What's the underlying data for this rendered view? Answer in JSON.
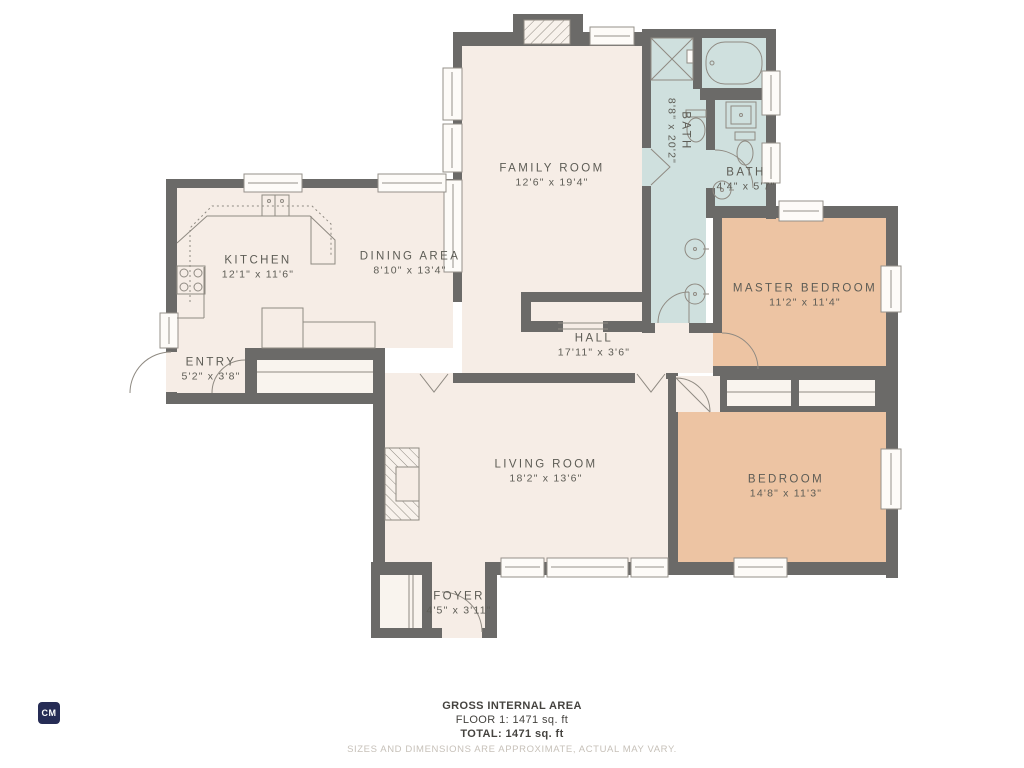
{
  "rooms": [
    {
      "id": "family_room",
      "name": "FAMILY ROOM",
      "dims": "12'6\" x 19'4\""
    },
    {
      "id": "bath_large",
      "name": "BATH",
      "dims": "8'8\" x 20'2\""
    },
    {
      "id": "bath_small",
      "name": "BATH",
      "dims": "4'4\" x 5'7\""
    },
    {
      "id": "kitchen",
      "name": "KITCHEN",
      "dims": "12'1\" x 11'6\""
    },
    {
      "id": "dining_area",
      "name": "DINING AREA",
      "dims": "8'10\" x 13'4\""
    },
    {
      "id": "master_bedroom",
      "name": "MASTER BEDROOM",
      "dims": "11'2\" x 11'4\""
    },
    {
      "id": "hall",
      "name": "HALL",
      "dims": "17'11\" x 3'6\""
    },
    {
      "id": "entry",
      "name": "ENTRY",
      "dims": "5'2\" x 3'8\""
    },
    {
      "id": "living_room",
      "name": "LIVING ROOM",
      "dims": "18'2\" x 13'6\""
    },
    {
      "id": "bedroom",
      "name": "BEDROOM",
      "dims": "14'8\" x 11'3\""
    },
    {
      "id": "foyer",
      "name": "FOYER",
      "dims": "4'5\" x 3'11\""
    }
  ],
  "footer": {
    "line1": "GROSS INTERNAL AREA",
    "line2": "FLOOR 1: 1471 sq. ft",
    "line3": "TOTAL: 1471 sq. ft",
    "disclaimer": "SIZES AND DIMENSIONS ARE APPROXIMATE, ACTUAL MAY VARY."
  },
  "logo": {
    "text": "CM"
  },
  "colors": {
    "wall": "#6b6a68",
    "floor_cream": "#f6ede6",
    "bath_blue": "#cfe0de",
    "bedroom_tan": "#edc4a3",
    "closet_white": "#f9f4ee",
    "line_thin": "#8f8a82",
    "label_text": "#5d5c55",
    "footer_text": "#45433f",
    "footer_light": "#c7c1b9",
    "logo_bg": "#262c55"
  }
}
